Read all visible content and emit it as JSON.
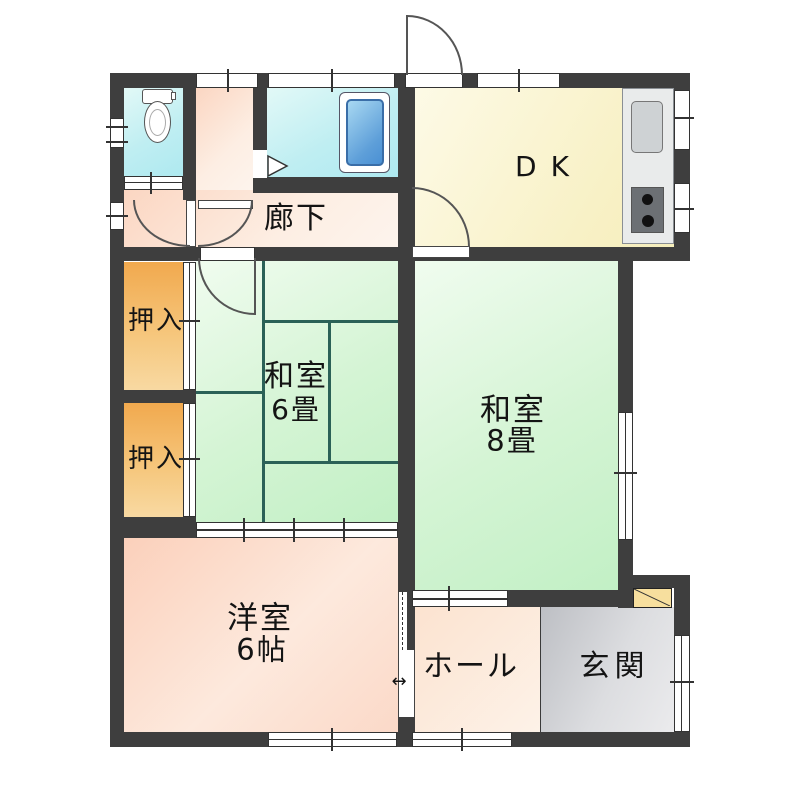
{
  "rooms": {
    "corridor": {
      "label": "廊下"
    },
    "dk": {
      "label": "DK"
    },
    "closet_upper": {
      "label": "押入"
    },
    "closet_lower": {
      "label": "押入"
    },
    "washitsu6": {
      "name": "和室",
      "size": "6畳"
    },
    "washitsu8": {
      "name": "和室",
      "size": "8畳"
    },
    "youshitsu": {
      "name": "洋室",
      "size": "6帖"
    },
    "hall": {
      "label": "ホール"
    },
    "genkan": {
      "label": "玄関"
    }
  },
  "icons": {
    "toilet": {
      "name": "toilet-icon",
      "shape": "css-rounded-rect-and-ellipse"
    },
    "bathtub": {
      "name": "bathtub-icon",
      "shape": "css-nested-rounded-rects"
    },
    "kitchen_sink": {
      "name": "kitchen-sink-icon",
      "shape": "css-rounded-rect"
    },
    "gas_stove": {
      "name": "stove-icon",
      "shape": "css-rect-two-burner-circles"
    },
    "shoe_cabinet": {
      "name": "shoe-cabinet-icon",
      "shape": "css-rect-diagonal"
    },
    "bath_folding_door": {
      "name": "bath-folding-door-icon",
      "shape": "svg-triangle-right"
    },
    "slide_arrow": {
      "name": "slide-direction-arrow-icon",
      "glyph": "↔"
    }
  },
  "colors": {
    "wall": "#3e3e3e",
    "tatami_line": "#2b6157",
    "tatami_floor": "#cdf3cd",
    "dk_floor": "#f8f1c6",
    "wet_floor": "#b5ecf2",
    "closet_floor": "#f2ad58",
    "wood_floor": "#fbd6c2",
    "youshitsu_floor": "#fbd2bd",
    "genkan_floor": "#c6c8cc",
    "shoe_cabinet": "#f7df9e",
    "bathtub": "#6aaede"
  }
}
